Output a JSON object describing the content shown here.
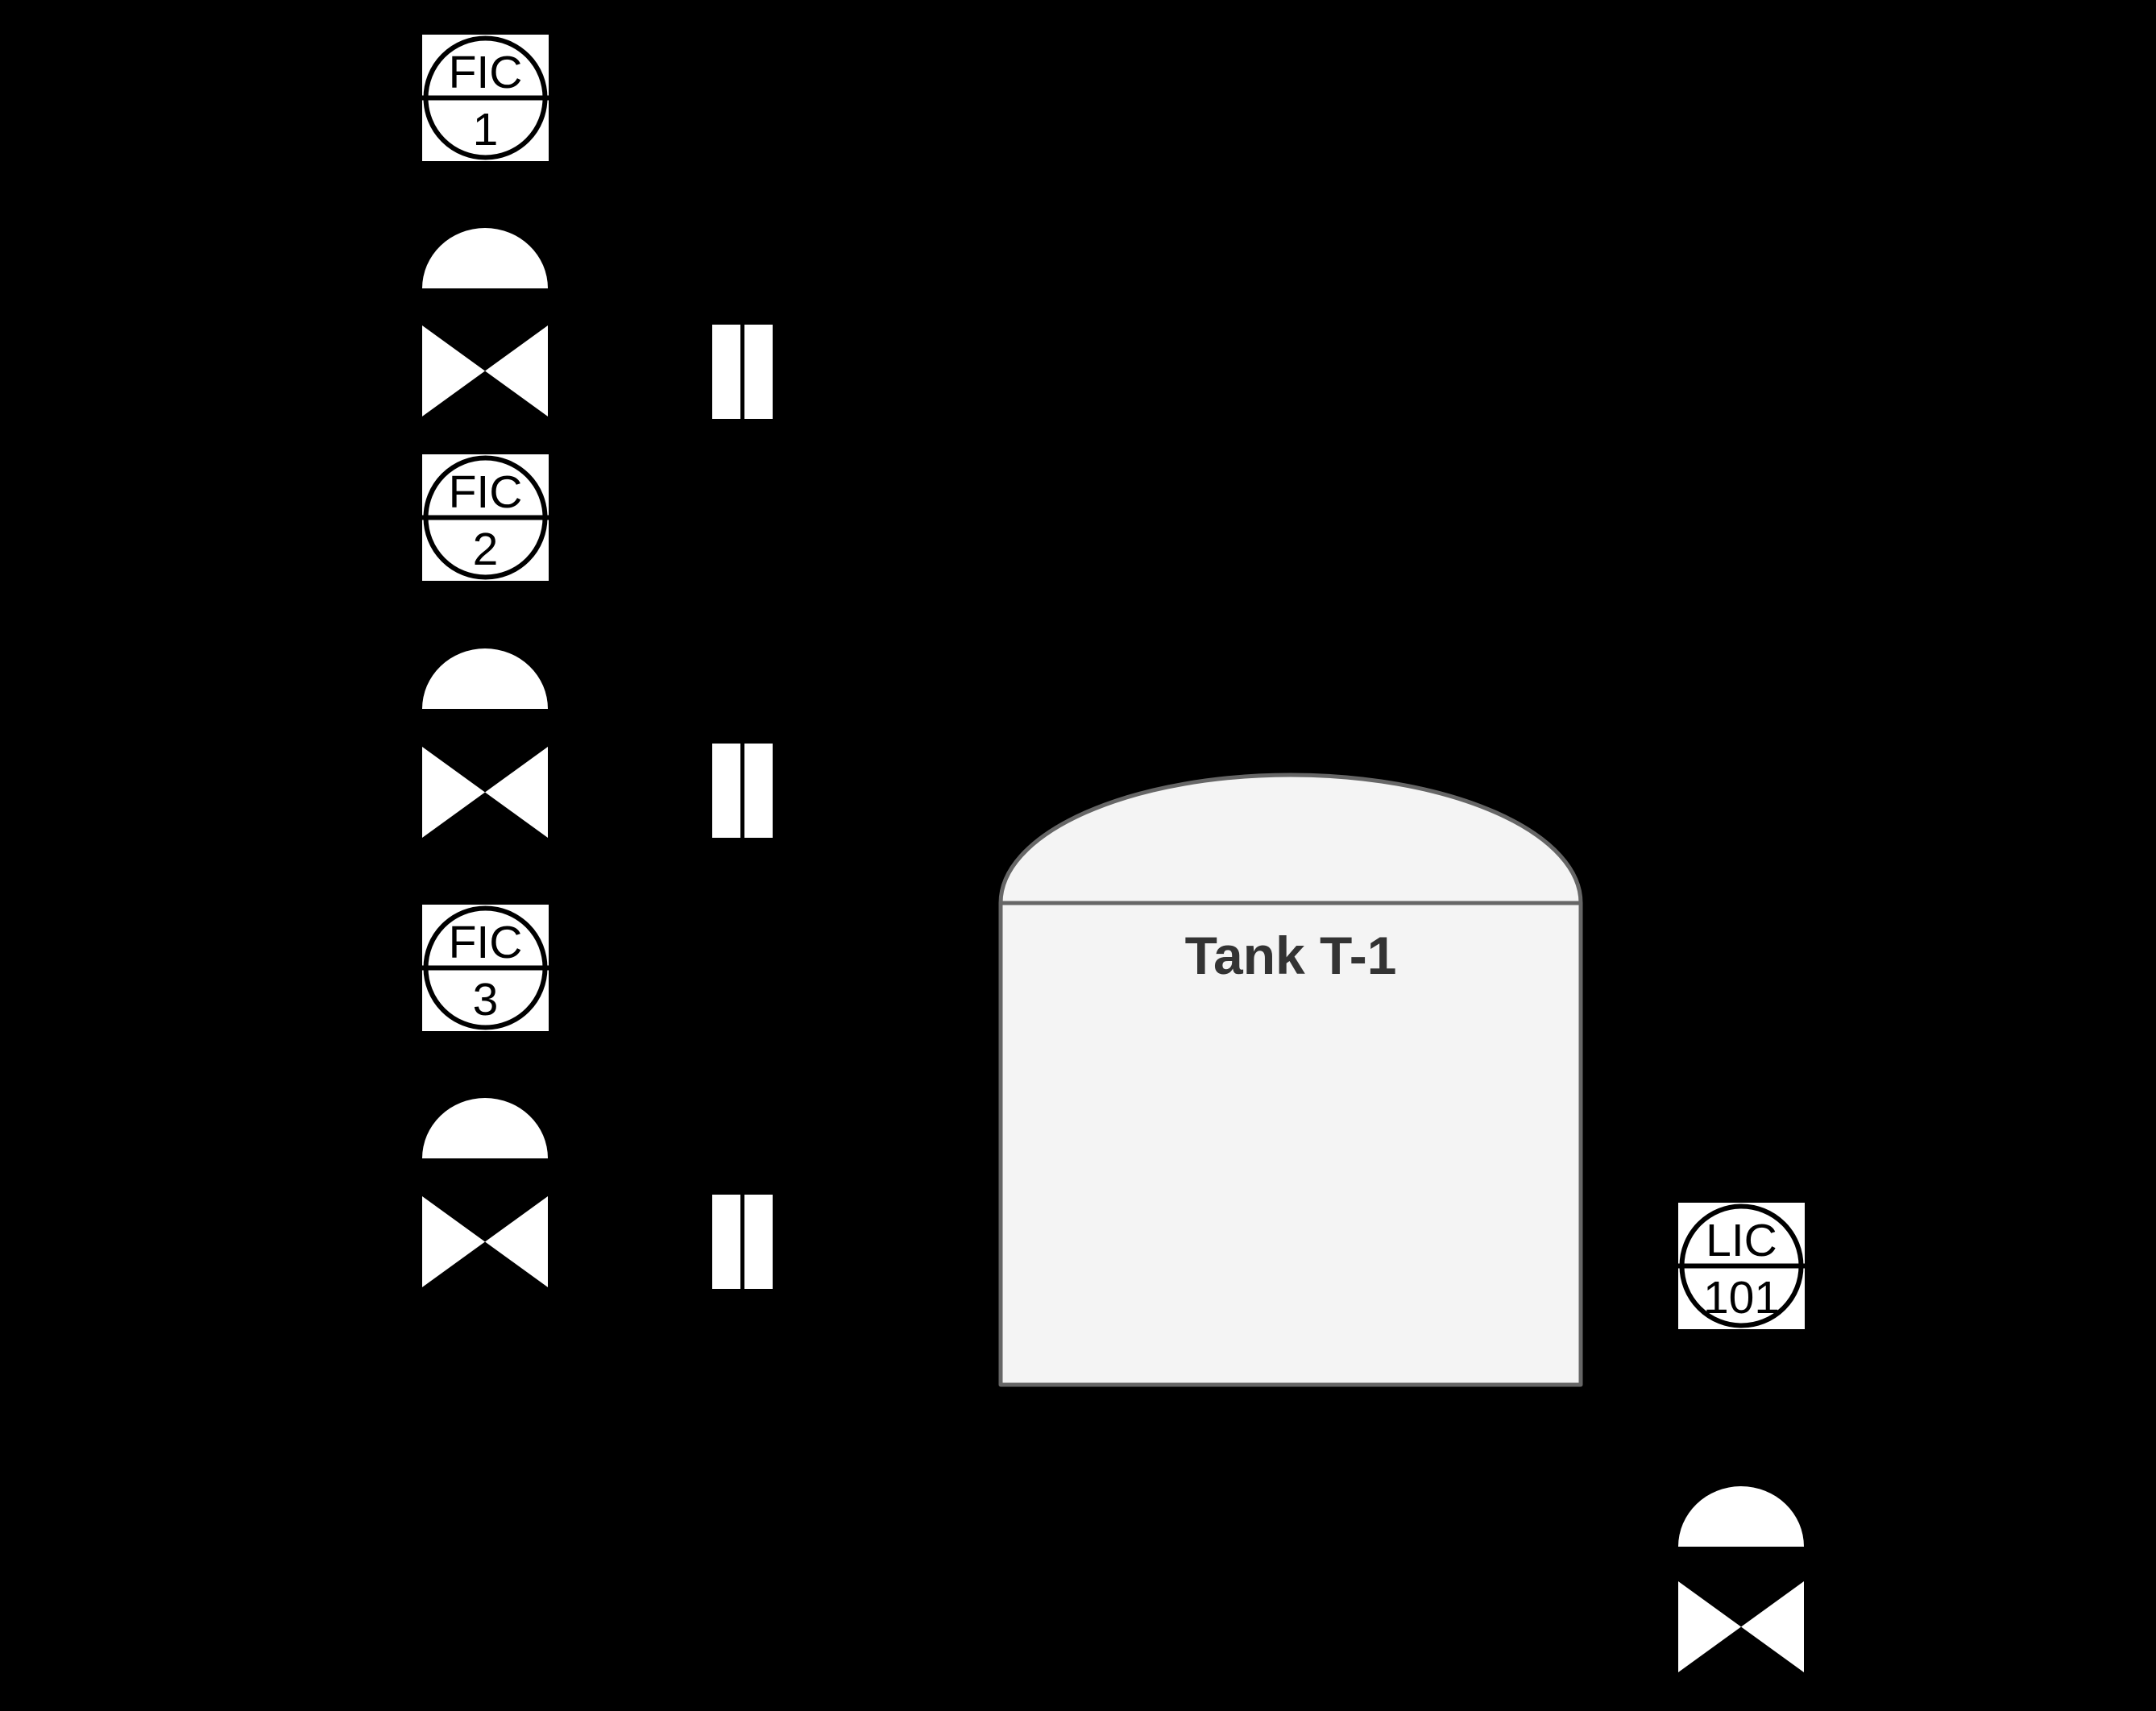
{
  "canvas": {
    "background": "#000000"
  },
  "instruments": [
    {
      "function": "FIC",
      "tag": "1"
    },
    {
      "function": "FIC",
      "tag": "2"
    },
    {
      "function": "FIC",
      "tag": "3"
    },
    {
      "function": "LIC",
      "tag": "101"
    }
  ],
  "tank": {
    "label": "Tank T-1"
  },
  "colors": {
    "symbol_fill": "#ffffff",
    "symbol_stroke": "#000000",
    "tank_fill": "#f4f4f4",
    "tank_stroke": "#666666",
    "tank_label_color": "#333333"
  }
}
